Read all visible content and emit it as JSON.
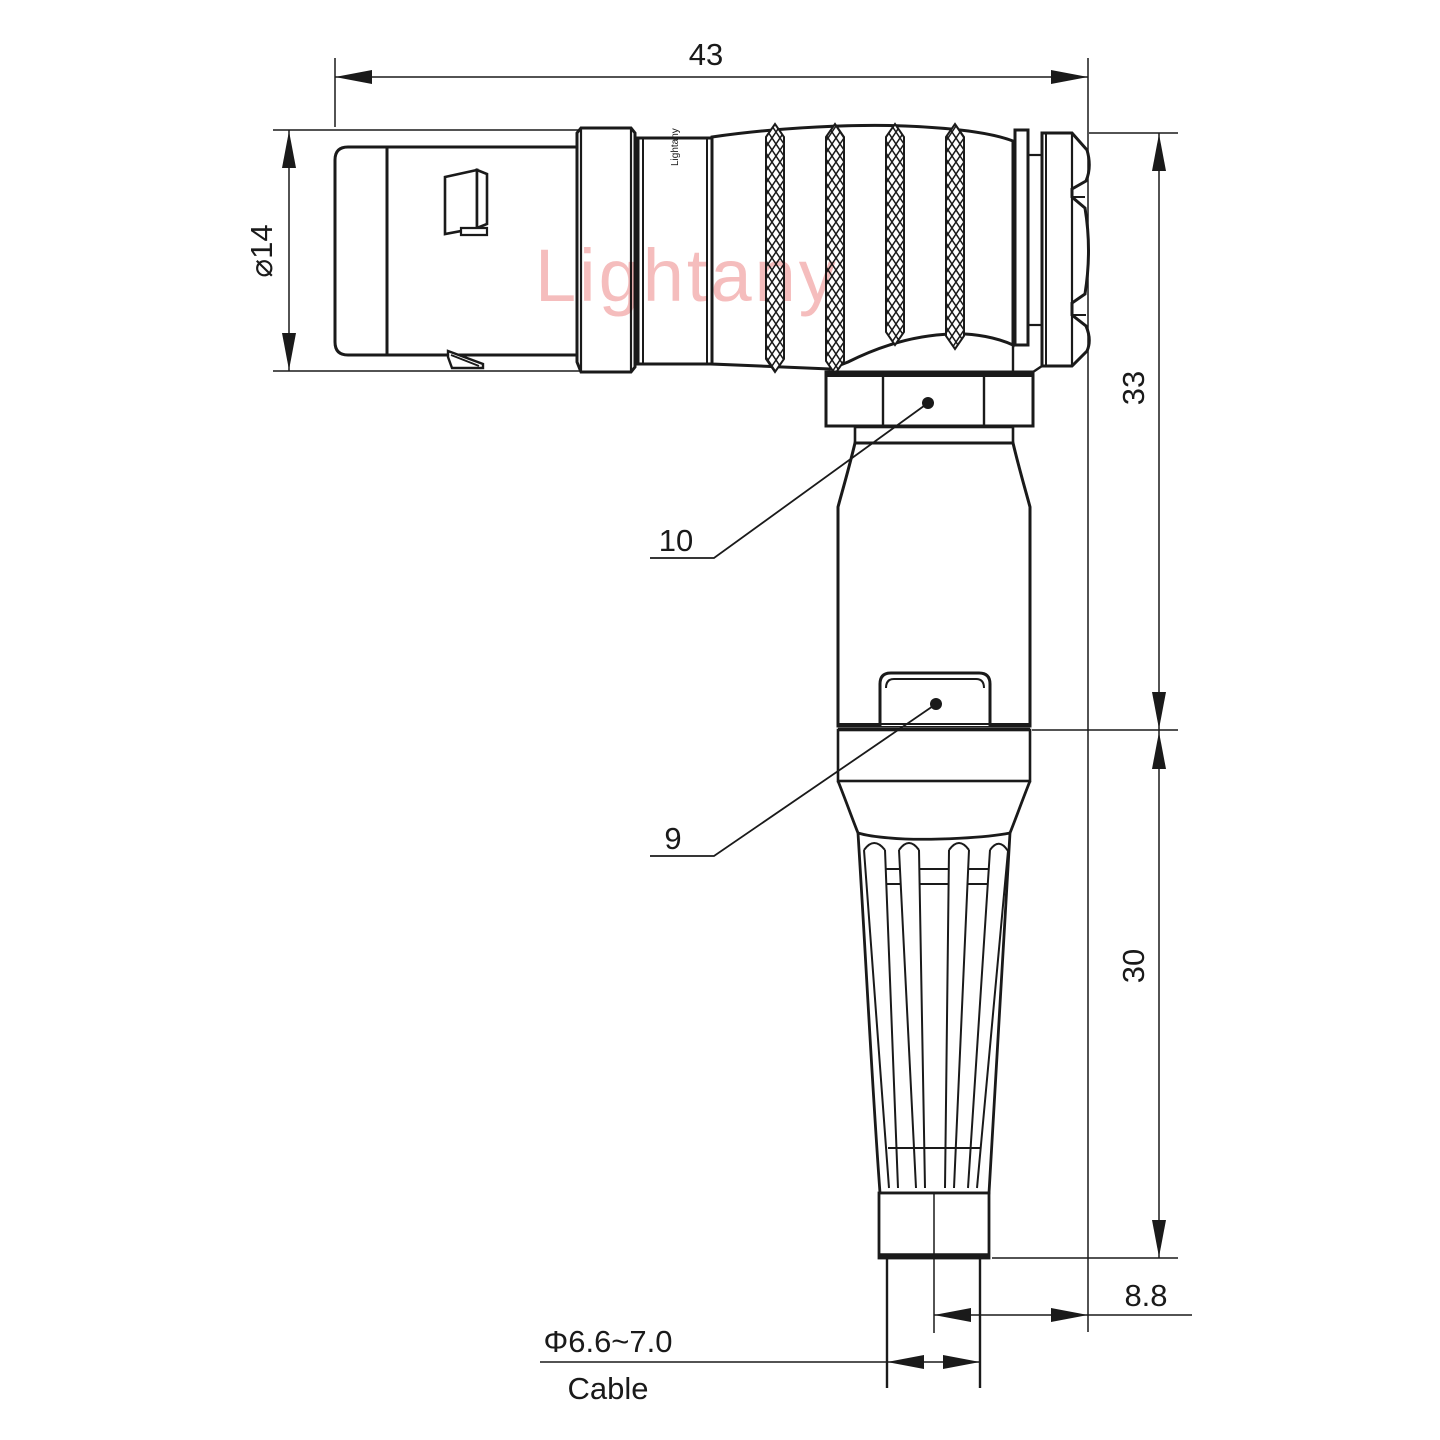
{
  "drawing": {
    "title": "right-angle connector technical drawing",
    "dimensions": {
      "overall_length": "43",
      "front_diameter": "⌀14",
      "upper_height": "33",
      "lower_height": "30",
      "offset": "8.8",
      "cable_diameter": "Φ6.6~7.0",
      "cable_label": "Cable"
    },
    "part_labels": {
      "coupling_nut": "10",
      "latch_clip": "9"
    },
    "watermark": {
      "text": "Lightany",
      "color": "#f5bdbd"
    },
    "body_logo": {
      "text": "Lightany"
    },
    "colors": {
      "line": "#1a1a1a",
      "background": "#ffffff",
      "watermark": "#f5bdbd"
    }
  }
}
